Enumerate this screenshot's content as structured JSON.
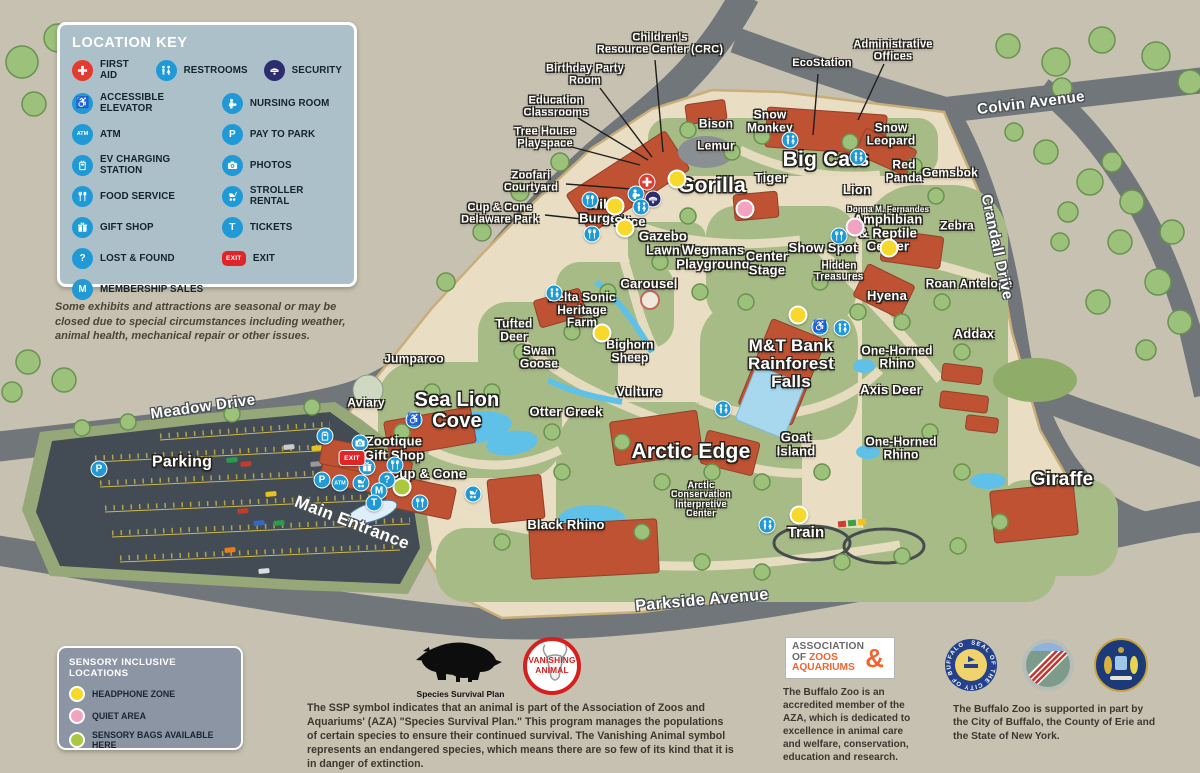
{
  "location_key": {
    "title": "LOCATION KEY",
    "row1": [
      {
        "icon": "first-aid",
        "label": "FIRST AID"
      },
      {
        "icon": "restrooms",
        "label": "RESTROOMS"
      },
      {
        "icon": "security",
        "label": "SECURITY"
      }
    ],
    "col1": [
      {
        "icon": "accessible-elevator",
        "label": "ACCESSIBLE ELEVATOR"
      },
      {
        "icon": "atm",
        "label": "ATM"
      },
      {
        "icon": "ev-charging",
        "label": "EV CHARGING STATION"
      },
      {
        "icon": "food-service",
        "label": "FOOD SERVICE"
      },
      {
        "icon": "gift-shop",
        "label": "GIFT SHOP"
      },
      {
        "icon": "lost-found",
        "label": "LOST & FOUND"
      },
      {
        "icon": "membership",
        "label": "MEMBERSHIP SALES"
      }
    ],
    "col2": [
      {
        "icon": "nursing-room",
        "label": "NURSING ROOM"
      },
      {
        "icon": "pay-to-park",
        "label": "PAY TO PARK"
      },
      {
        "icon": "photos",
        "label": "PHOTOS"
      },
      {
        "icon": "stroller-rental",
        "label": "STROLLER RENTAL"
      },
      {
        "icon": "tickets",
        "label": "TICKETS"
      },
      {
        "icon": "exit",
        "label": "EXIT"
      }
    ]
  },
  "seasonal_note": "Some exhibits and attractions are seasonal or may be closed due to special circumstances including weather, animal health, mechanical repair or other issues.",
  "sensory": {
    "title": "SENSORY INCLUSIVE LOCATIONS",
    "items": [
      {
        "key": "headphone-zone",
        "color": "#f6d92a",
        "label": "HEADPHONE ZONE"
      },
      {
        "key": "quiet-area",
        "color": "#f2a3c0",
        "label": "QUIET AREA"
      },
      {
        "key": "sensory-bags",
        "color": "#a9c83f",
        "label": "SENSORY BAGS AVAILABLE HERE"
      }
    ]
  },
  "ssp": {
    "caption": "Species Survival Plan",
    "badge_line1": "VANISHING",
    "badge_line2": "ANIMAL",
    "text": "The SSP symbol indicates that an animal is part of the Association of Zoos and Aquariums' (AZA) \"Species Survival Plan.\" This program manages the populations of certain species to ensure their continued survival. The Vanishing Animal symbol represents an endangered species, which means there are so few of its kind that it is in danger of extinction."
  },
  "aza": {
    "line1": "ASSOCIATION",
    "line2_gray": "OF",
    "line2_orange": "ZOOS",
    "amp": "&",
    "line3": "AQUARIUMS",
    "text": "The Buffalo Zoo is an accredited member of the AZA, which is dedicated to excellence in animal care and welfare, conservation, education and research."
  },
  "seals": {
    "buffalo_ring_text": "SEAL OF THE CITY OF BUFFALO",
    "support_text": "The Buffalo Zoo is supported in part by the City of Buffalo, the County of Erie and the State of New York."
  },
  "map": {
    "roads": [
      {
        "name": "Meadow Drive",
        "x": 203,
        "y": 407,
        "rot": -8,
        "fs": 15
      },
      {
        "name": "Colvin Avenue",
        "x": 1031,
        "y": 103,
        "rot": -7,
        "fs": 15
      },
      {
        "name": "Crandall Drive",
        "x": 997,
        "y": 247,
        "rot": 78,
        "fs": 15
      },
      {
        "name": "Parkside Avenue",
        "x": 702,
        "y": 601,
        "rot": -5,
        "fs": 16
      },
      {
        "name": "Main Entrance",
        "x": 352,
        "y": 523,
        "rot": 21,
        "fs": 17
      }
    ],
    "exhibit_labels": [
      {
        "text": "Bison",
        "x": 716,
        "y": 124,
        "fs": 12
      },
      {
        "text": "Snow\nMonkey",
        "x": 770,
        "y": 121,
        "fs": 12
      },
      {
        "text": "Lemur",
        "x": 716,
        "y": 146,
        "fs": 12
      },
      {
        "text": "Big Cats",
        "x": 826,
        "y": 160,
        "fs": 21
      },
      {
        "text": "Tiger",
        "x": 771,
        "y": 178,
        "fs": 13
      },
      {
        "text": "Lion",
        "x": 857,
        "y": 190,
        "fs": 13
      },
      {
        "text": "Snow\nLeopard",
        "x": 891,
        "y": 134,
        "fs": 12
      },
      {
        "text": "Red\nPanda",
        "x": 904,
        "y": 171,
        "fs": 12
      },
      {
        "text": "Gemsbok",
        "x": 950,
        "y": 173,
        "fs": 12
      },
      {
        "text": "Zebra",
        "x": 957,
        "y": 226,
        "fs": 12
      },
      {
        "text": "Donna M. Fernandes",
        "x": 888,
        "y": 210,
        "fs": 8
      },
      {
        "text": "Amphibian\n& Reptile\nCenter",
        "x": 888,
        "y": 233,
        "fs": 13
      },
      {
        "text": "Show Spot",
        "x": 823,
        "y": 248,
        "fs": 13
      },
      {
        "text": "Hidden\nTreasures",
        "x": 839,
        "y": 272,
        "fs": 10
      },
      {
        "text": "Hyena",
        "x": 887,
        "y": 296,
        "fs": 13
      },
      {
        "text": "Roan Antelope",
        "x": 969,
        "y": 284,
        "fs": 12
      },
      {
        "text": "Addax",
        "x": 974,
        "y": 334,
        "fs": 13
      },
      {
        "text": "One-Horned\nRhino",
        "x": 897,
        "y": 357,
        "fs": 12
      },
      {
        "text": "Axis Deer",
        "x": 891,
        "y": 390,
        "fs": 13
      },
      {
        "text": "One-Horned\nRhino",
        "x": 901,
        "y": 448,
        "fs": 12
      },
      {
        "text": "Giraffe",
        "x": 1062,
        "y": 480,
        "fs": 19
      },
      {
        "text": "Gorilla",
        "x": 712,
        "y": 186,
        "fs": 21
      },
      {
        "text": "Wild\nBurger",
        "x": 601,
        "y": 211,
        "fs": 13
      },
      {
        "text": "Slice",
        "x": 630,
        "y": 222,
        "fs": 13
      },
      {
        "text": "Gazebo\nLawn",
        "x": 663,
        "y": 243,
        "fs": 13
      },
      {
        "text": "Wegmans\nPlayground",
        "x": 713,
        "y": 257,
        "fs": 13
      },
      {
        "text": "Center\nStage",
        "x": 767,
        "y": 263,
        "fs": 13
      },
      {
        "text": "Carousel",
        "x": 649,
        "y": 284,
        "fs": 13
      },
      {
        "text": "Delta Sonic\nHeritage\nFarm",
        "x": 582,
        "y": 310,
        "fs": 12
      },
      {
        "text": "Tufted\nDeer",
        "x": 514,
        "y": 330,
        "fs": 12
      },
      {
        "text": "Swan\nGoose",
        "x": 539,
        "y": 357,
        "fs": 12
      },
      {
        "text": "Bighorn\nSheep",
        "x": 630,
        "y": 351,
        "fs": 12
      },
      {
        "text": "Vulture",
        "x": 639,
        "y": 392,
        "fs": 13
      },
      {
        "text": "M&T Bank\nRainforest\nFalls",
        "x": 791,
        "y": 364,
        "fs": 17
      },
      {
        "text": "Jumparoo",
        "x": 414,
        "y": 359,
        "fs": 12
      },
      {
        "text": "Aviary",
        "x": 366,
        "y": 403,
        "fs": 12
      },
      {
        "text": "Sea Lion\nCove",
        "x": 457,
        "y": 411,
        "fs": 20
      },
      {
        "text": "Otter Creek",
        "x": 566,
        "y": 412,
        "fs": 13
      },
      {
        "text": "Zootique\nGift Shop",
        "x": 394,
        "y": 448,
        "fs": 13
      },
      {
        "text": "Cup & Cone",
        "x": 428,
        "y": 474,
        "fs": 13
      },
      {
        "text": "Arctic Edge",
        "x": 691,
        "y": 452,
        "fs": 21
      },
      {
        "text": "Goat\nIsland",
        "x": 796,
        "y": 444,
        "fs": 13
      },
      {
        "text": "Black Rhino",
        "x": 566,
        "y": 525,
        "fs": 13
      },
      {
        "text": "Arctic\nConservation\nInterpretive\nCenter",
        "x": 701,
        "y": 500,
        "fs": 9
      },
      {
        "text": "Train",
        "x": 806,
        "y": 533,
        "fs": 15
      },
      {
        "text": "Parking",
        "x": 182,
        "y": 463,
        "fs": 16
      }
    ],
    "callouts": [
      {
        "text": "Children's\nResource Center (CRC)",
        "x": 660,
        "y": 44,
        "fs": 11,
        "line": [
          655,
          60,
          663,
          152
        ]
      },
      {
        "text": "Birthday Party\nRoom",
        "x": 585,
        "y": 75,
        "fs": 11,
        "line": [
          600,
          88,
          652,
          157
        ]
      },
      {
        "text": "Education\nClassrooms",
        "x": 556,
        "y": 107,
        "fs": 11,
        "line": [
          578,
          118,
          648,
          160
        ]
      },
      {
        "text": "Tree House\nPlayspace",
        "x": 545,
        "y": 138,
        "fs": 11,
        "line": [
          568,
          146,
          640,
          165
        ]
      },
      {
        "text": "EcoStation",
        "x": 822,
        "y": 64,
        "fs": 11,
        "line": [
          818,
          74,
          813,
          135
        ]
      },
      {
        "text": "Administrative\nOffices",
        "x": 893,
        "y": 51,
        "fs": 11,
        "line": [
          884,
          64,
          858,
          120
        ]
      },
      {
        "text": "Zoofari\nCourtyard",
        "x": 531,
        "y": 182,
        "fs": 11,
        "line": [
          566,
          184,
          645,
          190
        ]
      },
      {
        "text": "Cup & Cone\nDelaware Park",
        "x": 500,
        "y": 214,
        "fs": 11,
        "line": [
          545,
          215,
          582,
          219
        ]
      }
    ],
    "sensory_dots": [
      {
        "type": "headphone-zone",
        "x": 677,
        "y": 179
      },
      {
        "type": "headphone-zone",
        "x": 615,
        "y": 206
      },
      {
        "type": "headphone-zone",
        "x": 625,
        "y": 228
      },
      {
        "type": "headphone-zone",
        "x": 602,
        "y": 333
      },
      {
        "type": "headphone-zone",
        "x": 798,
        "y": 315
      },
      {
        "type": "headphone-zone",
        "x": 889,
        "y": 248
      },
      {
        "type": "headphone-zone",
        "x": 799,
        "y": 515
      },
      {
        "type": "quiet-area",
        "x": 745,
        "y": 209
      },
      {
        "type": "quiet-area",
        "x": 855,
        "y": 227
      },
      {
        "type": "sensory-bags",
        "x": 402,
        "y": 487
      }
    ],
    "facility_markers": [
      {
        "icon": "first-aid",
        "x": 647,
        "y": 182
      },
      {
        "icon": "nursing-room",
        "x": 636,
        "y": 194
      },
      {
        "icon": "security",
        "x": 653,
        "y": 199
      },
      {
        "icon": "restrooms",
        "x": 641,
        "y": 207
      },
      {
        "icon": "restrooms",
        "x": 790,
        "y": 140
      },
      {
        "icon": "restrooms",
        "x": 858,
        "y": 157
      },
      {
        "icon": "restrooms",
        "x": 554,
        "y": 293
      },
      {
        "icon": "restrooms",
        "x": 723,
        "y": 409
      },
      {
        "icon": "restrooms",
        "x": 767,
        "y": 525
      },
      {
        "icon": "restrooms",
        "x": 842,
        "y": 328
      },
      {
        "icon": "accessible-elevator",
        "x": 414,
        "y": 420
      },
      {
        "icon": "accessible-elevator",
        "x": 820,
        "y": 327
      },
      {
        "icon": "food-service",
        "x": 590,
        "y": 200
      },
      {
        "icon": "food-service",
        "x": 592,
        "y": 234
      },
      {
        "icon": "food-service",
        "x": 839,
        "y": 236
      },
      {
        "icon": "food-service",
        "x": 395,
        "y": 465
      },
      {
        "icon": "food-service",
        "x": 420,
        "y": 503
      },
      {
        "icon": "photos",
        "x": 360,
        "y": 443
      },
      {
        "icon": "gift-shop",
        "x": 367,
        "y": 467
      },
      {
        "icon": "ev-charging",
        "x": 325,
        "y": 436
      },
      {
        "icon": "pay-to-park",
        "x": 322,
        "y": 480
      },
      {
        "icon": "pay-to-park",
        "x": 99,
        "y": 469
      },
      {
        "icon": "atm",
        "x": 340,
        "y": 483
      },
      {
        "icon": "stroller-rental",
        "x": 361,
        "y": 483
      },
      {
        "icon": "stroller-rental",
        "x": 473,
        "y": 494
      },
      {
        "icon": "lost-found",
        "x": 387,
        "y": 480
      },
      {
        "icon": "membership",
        "x": 379,
        "y": 491
      },
      {
        "icon": "tickets",
        "x": 374,
        "y": 503
      },
      {
        "icon": "exit",
        "x": 352,
        "y": 458
      }
    ]
  }
}
